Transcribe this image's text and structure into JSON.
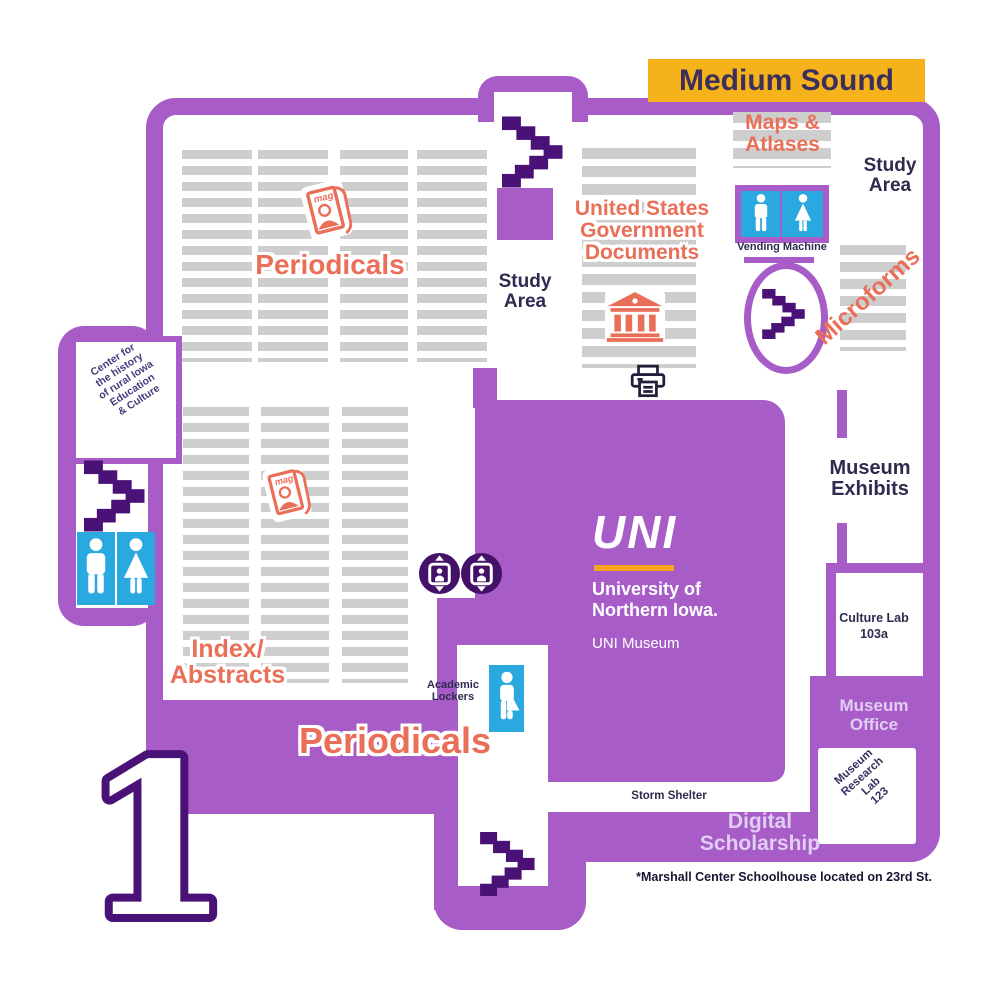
{
  "banner": {
    "label": "Medium Sound"
  },
  "floor": {
    "number": "1"
  },
  "areas": {
    "periodicals_top": "Periodicals",
    "periodicals_bottom": "Periodicals",
    "study_area_center": [
      "Study",
      "Area"
    ],
    "study_area_right": [
      "Study",
      "Area"
    ],
    "us_gov_docs": [
      "United States",
      "Government",
      "Documents"
    ],
    "maps_atlases": [
      "Maps &",
      "Atlases"
    ],
    "microforms": "Microforms",
    "index_abstracts": [
      "Index/",
      "Abstracts"
    ],
    "museum_exhibits": [
      "Museum",
      "Exhibits"
    ],
    "culture_lab": [
      "Culture Lab",
      "103a"
    ],
    "museum_office": [
      "Museum",
      "Office"
    ],
    "museum_research_lab": [
      "Museum",
      "Research",
      "Lab",
      "123"
    ],
    "digital_scholarship": [
      "Digital",
      "Scholarship"
    ],
    "storm_shelter": "Storm Shelter",
    "academic_lockers": [
      "Academic",
      "Lockers"
    ],
    "vending_machine": "Vending Machine",
    "center_history": [
      "Center for",
      "the history",
      "of rural Iowa",
      "Education",
      "& Culture"
    ]
  },
  "logo": {
    "uni": "UNI",
    "line1": "University of",
    "line2": "Northern Iowa.",
    "line3": "UNI Museum"
  },
  "magazine_label": "mag",
  "footnote": "*Marshall Center Schoolhouse located on 23rd St.",
  "colors": {
    "wall_purple": "#a75cc8",
    "dark_purple": "#4a1277",
    "text_dark": "#2f2a4f",
    "accent_orange": "#ea6f58",
    "banner_gold": "#f6b21b",
    "shelf_gray": "#cecece",
    "restroom_blue": "#2aa9e0",
    "label_lavender": "#e0cdf2",
    "logo_gold": "#f5a41f"
  }
}
